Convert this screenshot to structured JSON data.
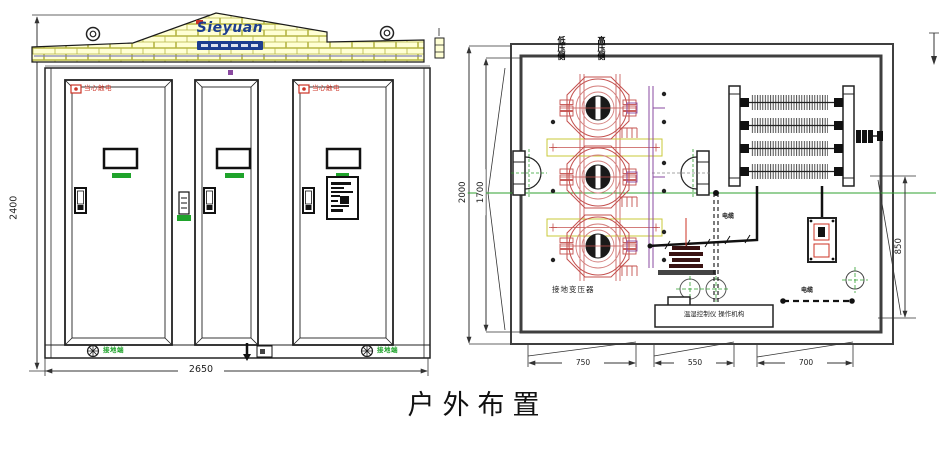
{
  "title": {
    "text": "户外布置"
  },
  "front_view": {
    "brand_logo": "Sieyuan",
    "dim_height": "2400",
    "dim_width": "2650",
    "warning_left": "当心触电",
    "warning_right": "当心触电",
    "ground_left": "接地端",
    "ground_right": "接地端"
  },
  "plan_view": {
    "dim_outer": "2000",
    "dim_inner": "1700",
    "dim_right": "850",
    "dim_bottom": [
      "750",
      "550",
      "700"
    ],
    "label_transformer": "接地变压器",
    "label_controller": "温湿控制仪 操作机构",
    "label_top_left": "低压侧",
    "label_top_right": "高压侧",
    "label_cable_mid": "电缆",
    "label_cable_right": "电缆"
  },
  "icons": {
    "lifting_eye": "ring-circle",
    "ground_terminal": "circled-cross",
    "down_arrow": "filled-arrow-down",
    "warning_badge": "red-box"
  },
  "colors": {
    "brick_fill": "#ffffd4",
    "brick_line": "#b5b545",
    "logo_blue": "#1c3d8f",
    "warning_red": "#cc3326",
    "green": "#1fa32b",
    "centerline_green": "#2fa02f",
    "transformer_red": "#c4504e",
    "purple": "#8a4aa0",
    "wall_gray": "#3f3f3f"
  }
}
